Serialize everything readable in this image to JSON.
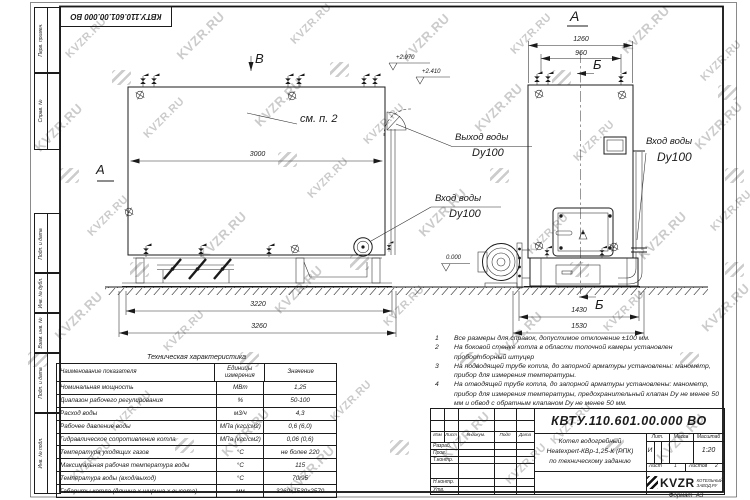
{
  "watermark": {
    "text": "KVZR.RU"
  },
  "frame": {
    "corner_stamp": "КВТУ.110.601.00.000  ВО",
    "side_fields": [
      "Перв. примен.",
      "Справ. №",
      "Подп. и дата",
      "Инв. № дубл.",
      "Взам. инв. №",
      "Подп. и дата",
      "Инв. № подл."
    ]
  },
  "left_view": {
    "section_label": "А",
    "view_label": "В",
    "note_ref": "см. п. 2",
    "elevation_top": "+2.970",
    "elevation_mid": "+2.410",
    "elevation_zero": "0.000",
    "dim_body": "3000",
    "dim_frame": "3220",
    "dim_overall": "3260",
    "inlet_title": "Вход воды",
    "inlet_dn": "Dy100",
    "outlet_title": "Выход воды",
    "outlet_dn": "Dy100"
  },
  "right_view": {
    "view_label": "А",
    "arrow_label_top": "Б",
    "arrow_label_bottom": "Б",
    "dim_top_outer": "1260",
    "dim_top_inner": "960",
    "dim_bottom_inner": "1430",
    "dim_bottom_outer": "1530",
    "inlet_title": "Вход воды",
    "inlet_dn": "Dy100"
  },
  "notes": [
    {
      "num": "1",
      "text": "Все размеры для справок, допустимое отклонение ±100 мм."
    },
    {
      "num": "2",
      "text": "На боковой стенке котла в области топочной камеры установлен пробоотборный штуцер"
    },
    {
      "num": "3",
      "text": "На подводящей трубе котла, до запорной арматуры установлены: манометр, прибор для измерения температуры."
    },
    {
      "num": "4",
      "text": "На отводящей трубе котла, до запорной арматуры установлены: манометр, прибор для измерения температуры, предохранительный клапан Dу не менее 50 мм и обвод с обратным клапаном Dу не менее 50 мм."
    }
  ],
  "tech_table": {
    "title": "Техническая характеристика",
    "headers": {
      "name": "Наименование показателя",
      "units": "Единицы измерения",
      "value": "Значение"
    },
    "rows": [
      {
        "name": "Номинальная мощность",
        "units": "МВт",
        "value": "1,25"
      },
      {
        "name": "Диапазон рабочего регулирования",
        "units": "%",
        "value": "50-100"
      },
      {
        "name": "Расход воды",
        "units": "м3/ч",
        "value": "4,3"
      },
      {
        "name": "Рабочее давление воды",
        "units": "МПа (кгс/см2)",
        "value": "0,6 (6,0)"
      },
      {
        "name": "Гидравлическое сопротивление котла",
        "units": "МПа (кгс/см2)",
        "value": "0,06 (0,6)"
      },
      {
        "name": "Температура уходящих газов",
        "units": "°С",
        "value": "не более 220"
      },
      {
        "name": "Максимальная рабочая температура воды",
        "units": "°С",
        "value": "115"
      },
      {
        "name": "Температура воды (вход/выход)",
        "units": "°С",
        "value": "70/95"
      },
      {
        "name": "Габариты котла (длинна х ширина х высота)",
        "units": "мм",
        "value": "3260х1530х2570"
      }
    ]
  },
  "title_block": {
    "doc_number": "КВТУ.110.601.00.000  ВО",
    "name_lines": [
      "Котел водогрейный",
      "Heatexpert-КВр-1,25-К (РПК)",
      "по техническому заданию"
    ],
    "rev_headers": [
      "Изм",
      "Лист",
      "N докум.",
      "Подп",
      "Дата"
    ],
    "sig_labels": [
      "Разраб.",
      "Пров.",
      "Т.контр.",
      "Н.контр.",
      "Утв."
    ],
    "lit_label": "Лит.",
    "lit_value": "И",
    "mass_label": "Масса",
    "scale_label": "Масштаб",
    "scale_value": "1:20",
    "sheet_label": "Лист",
    "sheet_value": "1",
    "sheets_label": "Листов",
    "sheets_value": "2",
    "brand": "KVZR",
    "brand_sub1": "КОТЕЛЬНЫЙ",
    "brand_sub2": "ЗАВОД.РУ",
    "format_label": "Формат",
    "format_value": "А3"
  }
}
